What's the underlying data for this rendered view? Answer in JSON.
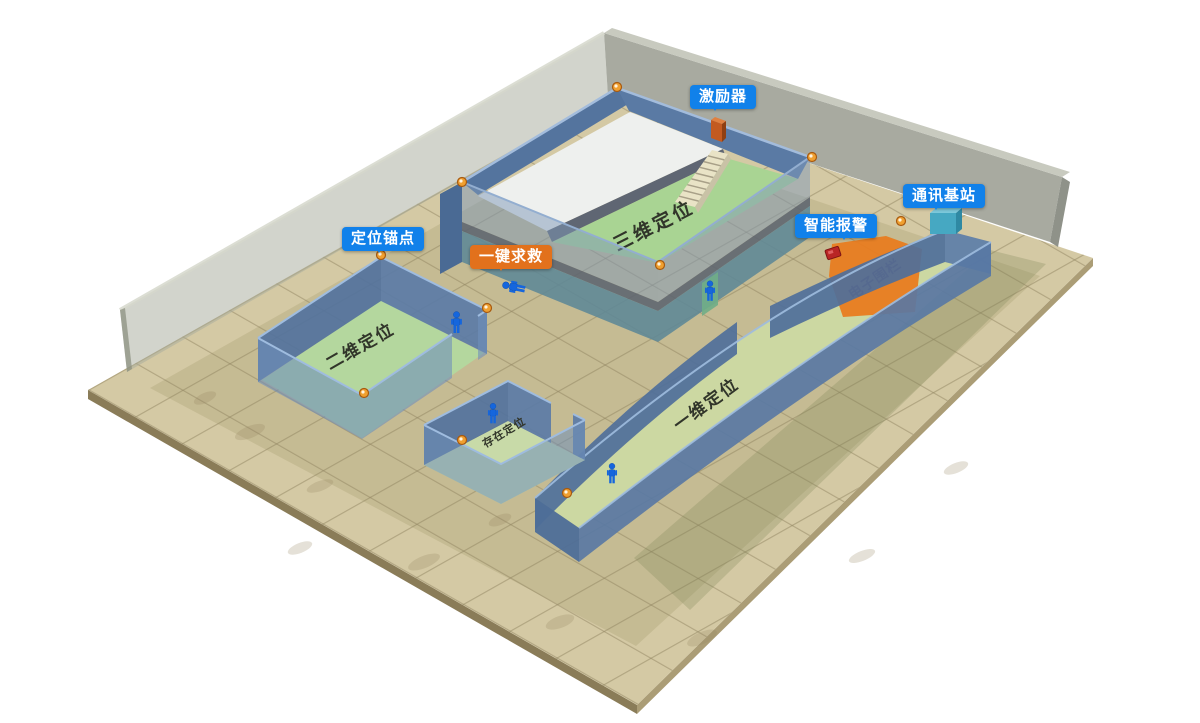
{
  "scene": {
    "description": "3D indoor positioning demo scene"
  },
  "callouts": {
    "exciter": "激励器",
    "base_station": "通讯基站",
    "smart_alarm": "智能报警",
    "anchor_point": "定位锚点",
    "sos_button": "一键求救"
  },
  "zones": {
    "zone_3d": "三维定位",
    "zone_2d": "二维定位",
    "zone_presence": "存在定位",
    "zone_1d": "一维定位",
    "efence": "电子围栏"
  },
  "colors": {
    "callout_blue": "#1181EA",
    "callout_orange": "#E2711C",
    "efence_orange": "#E87C20",
    "wall_blue": "#5B7DAB",
    "wall_teal": "#5D8896",
    "floor_green": "#B5D79E",
    "ground_tan": "#CFC49E",
    "back_wall_gray": "#A4A79C",
    "person_blue": "#1566DD",
    "anchor_orange": "#F0A030"
  }
}
